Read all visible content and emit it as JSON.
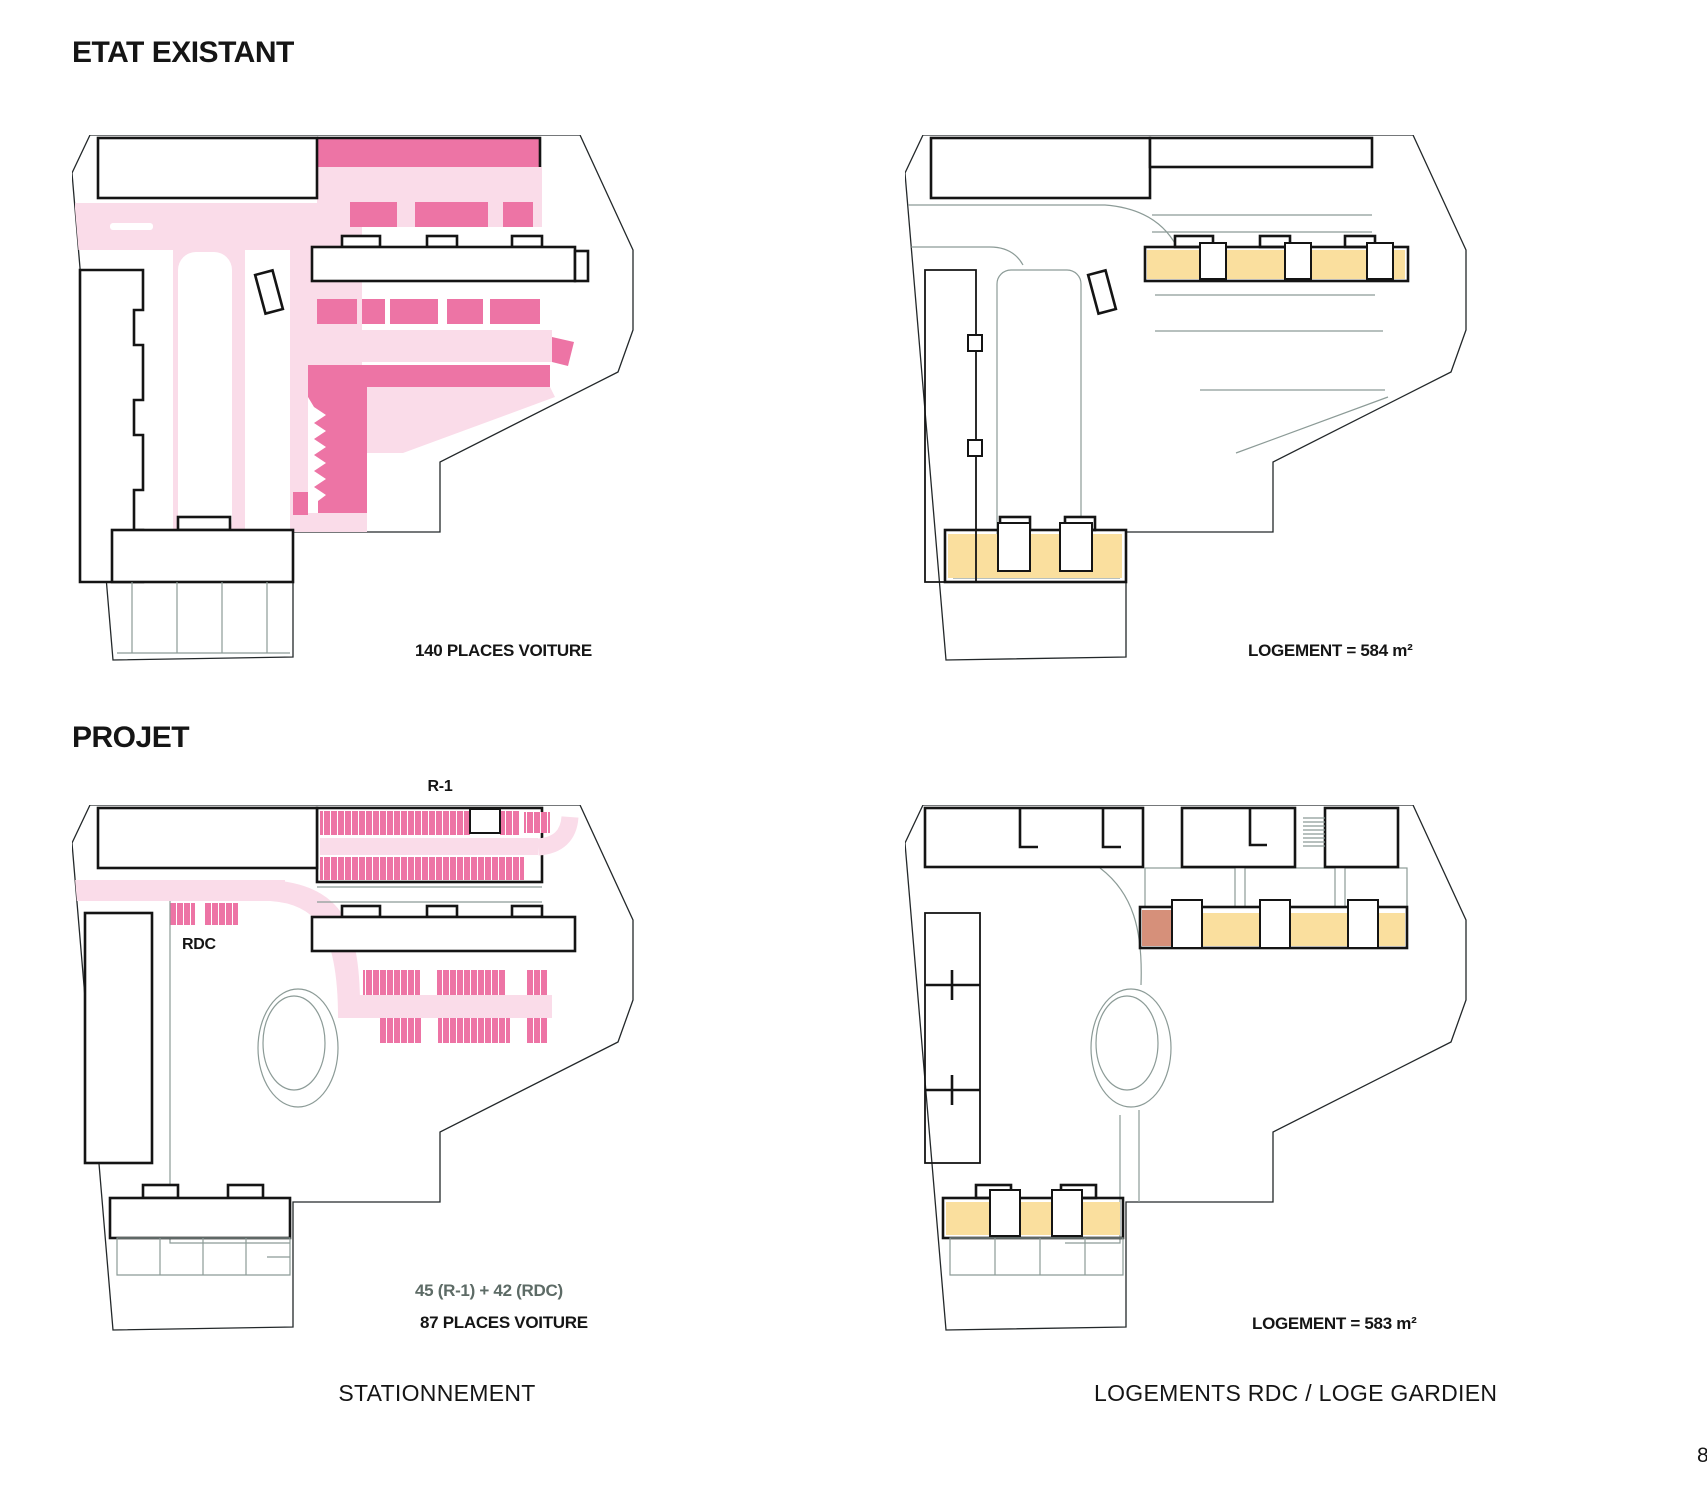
{
  "page": {
    "number_partial": "8"
  },
  "colors": {
    "parking_fill": "#ED74A5",
    "circulation_fill": "#FADCE9",
    "housing_fill": "#FADF9E",
    "caretaker_fill": "#D6907A",
    "outline": "#141414",
    "road_line": "#8C9B97",
    "muted_text": "#5D6B66"
  },
  "sections": {
    "existing": {
      "title": "ETAT EXISTANT",
      "parking_stat": "140 PLACES VOITURE",
      "housing_stat": "LOGEMENT = 584 m²"
    },
    "project": {
      "title": "PROJET",
      "level_upper_label": "R-1",
      "level_ground_label": "RDC",
      "parking_breakdown": "45 (R-1) + 42 (RDC)",
      "parking_stat": "87 PLACES VOITURE",
      "housing_stat": "LOGEMENT = 583 m²"
    }
  },
  "captions": {
    "left": "STATIONNEMENT",
    "right": "LOGEMENTS RDC / LOGE GARDIEN"
  }
}
